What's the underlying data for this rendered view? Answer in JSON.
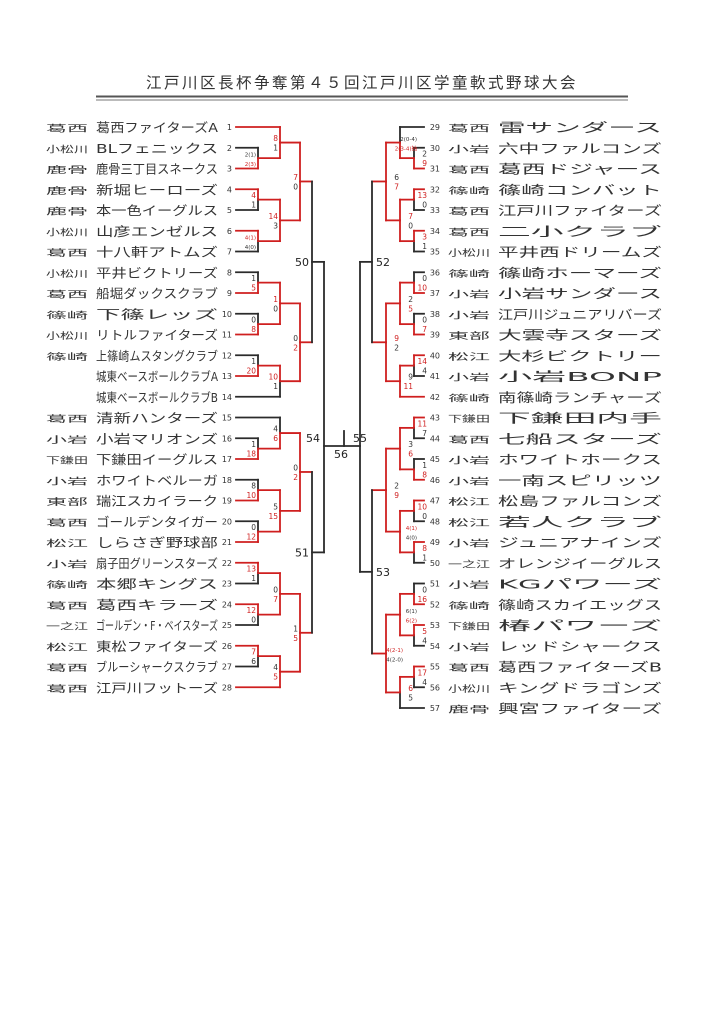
{
  "title": "江戸川区長杯争奪第４５回江戸川区学童軟式野球大会",
  "colors": {
    "win_path": "#cf1f1f",
    "line": "#2b2b2b",
    "score_win": "#cf1f1f",
    "score_lose": "#333333"
  },
  "bracket_labels": {
    "semi_left": "54",
    "semi_right": "55",
    "final": "56",
    "quarter_left_top": "50",
    "quarter_left_bottom": "51",
    "quarter_right_top": "52",
    "quarter_right_bottom": "53"
  },
  "teams": [
    {
      "n": 1,
      "region": "葛西",
      "name": "葛西ファイターズA"
    },
    {
      "n": 2,
      "region": "小松川",
      "name": "BLフェニックス"
    },
    {
      "n": 3,
      "region": "鹿骨",
      "name": "鹿骨三丁目スネークス"
    },
    {
      "n": 4,
      "region": "鹿骨",
      "name": "新堀ヒーローズ"
    },
    {
      "n": 5,
      "region": "鹿骨",
      "name": "本一色イーグルス"
    },
    {
      "n": 6,
      "region": "小松川",
      "name": "山彦エンゼルス"
    },
    {
      "n": 7,
      "region": "葛西",
      "name": "十八軒アトムズ"
    },
    {
      "n": 8,
      "region": "小松川",
      "name": "平井ビクトリーズ"
    },
    {
      "n": 9,
      "region": "葛西",
      "name": "船堀ダックスクラブ"
    },
    {
      "n": 10,
      "region": "篠崎",
      "name": "下篠レッズ"
    },
    {
      "n": 11,
      "region": "小松川",
      "name": "リトルファイターズ"
    },
    {
      "n": 12,
      "region": "篠崎",
      "name": "上篠崎ムスタングクラブ"
    },
    {
      "n": 13,
      "region": "",
      "name": "城東ベースボールクラブA"
    },
    {
      "n": 14,
      "region": "",
      "name": "城東ベースボールクラブB"
    },
    {
      "n": 15,
      "region": "葛西",
      "name": "清新ハンターズ"
    },
    {
      "n": 16,
      "region": "小岩",
      "name": "小岩マリオンズ"
    },
    {
      "n": 17,
      "region": "下鎌田",
      "name": "下鎌田イーグルス"
    },
    {
      "n": 18,
      "region": "小岩",
      "name": "ホワイトベルーガ"
    },
    {
      "n": 19,
      "region": "東部",
      "name": "瑞江スカイラーク"
    },
    {
      "n": 20,
      "region": "葛西",
      "name": "ゴールデンタイガー"
    },
    {
      "n": 21,
      "region": "松江",
      "name": "しらさぎ野球部"
    },
    {
      "n": 22,
      "region": "小岩",
      "name": "扇子田グリーンスターズ"
    },
    {
      "n": 23,
      "region": "篠崎",
      "name": "本郷キングス"
    },
    {
      "n": 24,
      "region": "葛西",
      "name": "葛西キラーズ"
    },
    {
      "n": 25,
      "region": "一之江",
      "name": "ゴールデン・F・ベイスターズ"
    },
    {
      "n": 26,
      "region": "松江",
      "name": "東松ファイターズ"
    },
    {
      "n": 27,
      "region": "葛西",
      "name": "ブルーシャークスクラブ"
    },
    {
      "n": 28,
      "region": "葛西",
      "name": "江戸川フットーズ"
    },
    {
      "n": 29,
      "region": "葛西",
      "name": "雷サンダース"
    },
    {
      "n": 30,
      "region": "小岩",
      "name": "六中ファルコンズ"
    },
    {
      "n": 31,
      "region": "葛西",
      "name": "葛西ドジャース"
    },
    {
      "n": 32,
      "region": "篠崎",
      "name": "篠崎コンバット"
    },
    {
      "n": 33,
      "region": "葛西",
      "name": "江戸川ファイターズ"
    },
    {
      "n": 34,
      "region": "葛西",
      "name": "二小クラブ"
    },
    {
      "n": 35,
      "region": "小松川",
      "name": "平井西ドリームズ"
    },
    {
      "n": 36,
      "region": "篠崎",
      "name": "篠崎ホーマーズ"
    },
    {
      "n": 37,
      "region": "小岩",
      "name": "小岩サンダース"
    },
    {
      "n": 38,
      "region": "小岩",
      "name": "江戸川ジュニアリバーズ"
    },
    {
      "n": 39,
      "region": "東部",
      "name": "大雲寺スターズ"
    },
    {
      "n": 40,
      "region": "松江",
      "name": "大杉ビクトリー"
    },
    {
      "n": 41,
      "region": "小岩",
      "name": "小岩BONP"
    },
    {
      "n": 42,
      "region": "篠崎",
      "name": "南篠崎ランチャーズ"
    },
    {
      "n": 43,
      "region": "下鎌田",
      "name": "下鎌田内手"
    },
    {
      "n": 44,
      "region": "葛西",
      "name": "七船スターズ"
    },
    {
      "n": 45,
      "region": "小岩",
      "name": "ホワイトホークス"
    },
    {
      "n": 46,
      "region": "小岩",
      "name": "一南スピリッツ"
    },
    {
      "n": 47,
      "region": "松江",
      "name": "松島ファルコンズ"
    },
    {
      "n": 48,
      "region": "松江",
      "name": "若人クラブ"
    },
    {
      "n": 49,
      "region": "小岩",
      "name": "ジュニアナインズ"
    },
    {
      "n": 50,
      "region": "一之江",
      "name": "オレンジイーグルス"
    },
    {
      "n": 51,
      "region": "小岩",
      "name": "KGパワーズ"
    },
    {
      "n": 52,
      "region": "篠崎",
      "name": "篠崎スカイエッグス"
    },
    {
      "n": 53,
      "region": "下鎌田",
      "name": "椿パワーズ"
    },
    {
      "n": 54,
      "region": "小岩",
      "name": "レッドシャークス"
    },
    {
      "n": 55,
      "region": "葛西",
      "name": "葛西ファイターズB"
    },
    {
      "n": 56,
      "region": "小松川",
      "name": "キングドラゴンズ"
    },
    {
      "n": 57,
      "region": "鹿骨",
      "name": "興宮ファイターズ"
    }
  ],
  "matches": [
    {
      "id": "m23",
      "side": "L",
      "lvl": 1,
      "top": "T2",
      "bot": "T3",
      "s": [
        "2(1)",
        "2(3)"
      ],
      "w": "b",
      "tiny": true
    },
    {
      "id": "m1",
      "side": "L",
      "lvl": 2,
      "top": "T1",
      "bot": "m23",
      "s": [
        "8",
        "1"
      ],
      "w": "t"
    },
    {
      "id": "m45",
      "side": "L",
      "lvl": 1,
      "top": "T4",
      "bot": "T5",
      "s": [
        "4",
        "1"
      ],
      "w": "t"
    },
    {
      "id": "m67",
      "side": "L",
      "lvl": 1,
      "top": "T6",
      "bot": "T7",
      "s": [
        "4(1)",
        "4(0)"
      ],
      "w": "t",
      "tiny": true
    },
    {
      "id": "mE",
      "side": "L",
      "lvl": 2,
      "top": "m45",
      "bot": "m67",
      "s": [
        "14",
        "3"
      ],
      "w": "t"
    },
    {
      "id": "mQFA",
      "side": "L",
      "lvl": 3,
      "top": "m1",
      "bot": "mE",
      "s": [
        "7",
        "0"
      ],
      "w": "t"
    },
    {
      "id": "m89",
      "side": "L",
      "lvl": 1,
      "top": "T8",
      "bot": "T9",
      "s": [
        "1",
        "5"
      ],
      "w": "b"
    },
    {
      "id": "m1011",
      "side": "L",
      "lvl": 1,
      "top": "T10",
      "bot": "T11",
      "s": [
        "0",
        "8"
      ],
      "w": "b"
    },
    {
      "id": "mI",
      "side": "L",
      "lvl": 2,
      "top": "m89",
      "bot": "m1011",
      "s": [
        "1",
        "0"
      ],
      "w": "t"
    },
    {
      "id": "m1213",
      "side": "L",
      "lvl": 1,
      "top": "T12",
      "bot": "T13",
      "s": [
        "1",
        "20"
      ],
      "w": "b"
    },
    {
      "id": "mK",
      "side": "L",
      "lvl": 2,
      "top": "m1213",
      "bot": "T14",
      "s": [
        "10",
        "1"
      ],
      "w": "t"
    },
    {
      "id": "mQFB",
      "side": "L",
      "lvl": 3,
      "top": "mI",
      "bot": "mK",
      "s": [
        "0",
        "2"
      ],
      "w": "b"
    },
    {
      "id": "m1617",
      "side": "L",
      "lvl": 1,
      "top": "T16",
      "bot": "T17",
      "s": [
        "1",
        "18"
      ],
      "w": "b"
    },
    {
      "id": "mN",
      "side": "L",
      "lvl": 2,
      "top": "T15",
      "bot": "m1617",
      "s": [
        "4",
        "6"
      ],
      "w": "b"
    },
    {
      "id": "m1819",
      "side": "L",
      "lvl": 1,
      "top": "T18",
      "bot": "T19",
      "s": [
        "8",
        "10"
      ],
      "w": "b"
    },
    {
      "id": "m2021",
      "side": "L",
      "lvl": 1,
      "top": "T20",
      "bot": "T21",
      "s": [
        "0",
        "12"
      ],
      "w": "b"
    },
    {
      "id": "mQ",
      "side": "L",
      "lvl": 2,
      "top": "m1819",
      "bot": "m2021",
      "s": [
        "5",
        "15"
      ],
      "w": "b"
    },
    {
      "id": "mQFC",
      "side": "L",
      "lvl": 3,
      "top": "mN",
      "bot": "mQ",
      "s": [
        "0",
        "2"
      ],
      "w": "b"
    },
    {
      "id": "m2223",
      "side": "L",
      "lvl": 1,
      "top": "T22",
      "bot": "T23",
      "s": [
        "13",
        "1"
      ],
      "w": "t"
    },
    {
      "id": "m2425",
      "side": "L",
      "lvl": 1,
      "top": "T24",
      "bot": "T25",
      "s": [
        "12",
        "0"
      ],
      "w": "t"
    },
    {
      "id": "mU",
      "side": "L",
      "lvl": 2,
      "top": "m2223",
      "bot": "m2425",
      "s": [
        "0",
        "7"
      ],
      "w": "b"
    },
    {
      "id": "m2627",
      "side": "L",
      "lvl": 1,
      "top": "T26",
      "bot": "T27",
      "s": [
        "7",
        "6"
      ],
      "w": "t"
    },
    {
      "id": "mW",
      "side": "L",
      "lvl": 2,
      "top": "m2627",
      "bot": "T28",
      "s": [
        "4",
        "5"
      ],
      "w": "b"
    },
    {
      "id": "mQFD",
      "side": "L",
      "lvl": 3,
      "top": "mU",
      "bot": "mW",
      "s": [
        "1",
        "5"
      ],
      "w": "b"
    },
    {
      "id": "m3031",
      "side": "R",
      "lvl": 1,
      "top": "T30",
      "bot": "T31",
      "s": [
        "2",
        "9"
      ],
      "w": "b"
    },
    {
      "id": "mB29",
      "side": "R",
      "lvl": 2,
      "top": "T29",
      "bot": "m3031",
      "s": [
        "2(0-4)",
        "2(3-4)抽"
      ],
      "w": "b",
      "tiny": true
    },
    {
      "id": "m3233",
      "side": "R",
      "lvl": 1,
      "top": "T32",
      "bot": "T33",
      "s": [
        "13",
        "0"
      ],
      "w": "t"
    },
    {
      "id": "m3435",
      "side": "R",
      "lvl": 1,
      "top": "T34",
      "bot": "T35",
      "s": [
        "3",
        "1"
      ],
      "w": "t"
    },
    {
      "id": "mE2",
      "side": "R",
      "lvl": 2,
      "top": "m3233",
      "bot": "m3435",
      "s": [
        "7",
        "0"
      ],
      "w": "t"
    },
    {
      "id": "mQF1",
      "side": "R",
      "lvl": 3,
      "top": "mB29",
      "bot": "mE2",
      "s": [
        "6",
        "7"
      ],
      "w": "b"
    },
    {
      "id": "m3637",
      "side": "R",
      "lvl": 1,
      "top": "T36",
      "bot": "T37",
      "s": [
        "0",
        "10"
      ],
      "w": "b"
    },
    {
      "id": "m3839",
      "side": "R",
      "lvl": 1,
      "top": "T38",
      "bot": "T39",
      "s": [
        "0",
        "7"
      ],
      "w": "b"
    },
    {
      "id": "mI2",
      "side": "R",
      "lvl": 2,
      "top": "m3637",
      "bot": "m3839",
      "s": [
        "2",
        "5"
      ],
      "w": "b"
    },
    {
      "id": "m4041",
      "side": "R",
      "lvl": 1,
      "top": "T40",
      "bot": "T41",
      "s": [
        "14",
        "4"
      ],
      "w": "t"
    },
    {
      "id": "mK2",
      "side": "R",
      "lvl": 2,
      "top": "m4041",
      "bot": "T42",
      "s": [
        "9",
        "11"
      ],
      "w": "b"
    },
    {
      "id": "mQF2",
      "side": "R",
      "lvl": 3,
      "top": "mI2",
      "bot": "mK2",
      "s": [
        "9",
        "2"
      ],
      "w": "t"
    },
    {
      "id": "m4344",
      "side": "R",
      "lvl": 1,
      "top": "T43",
      "bot": "T44",
      "s": [
        "11",
        "7"
      ],
      "w": "t"
    },
    {
      "id": "m4546",
      "side": "R",
      "lvl": 1,
      "top": "T45",
      "bot": "T46",
      "s": [
        "1",
        "8"
      ],
      "w": "b"
    },
    {
      "id": "mO2",
      "side": "R",
      "lvl": 2,
      "top": "m4344",
      "bot": "m4546",
      "s": [
        "3",
        "6"
      ],
      "w": "b"
    },
    {
      "id": "m4748",
      "side": "R",
      "lvl": 1,
      "top": "T47",
      "bot": "T48",
      "s": [
        "10",
        "0"
      ],
      "w": "t"
    },
    {
      "id": "m4950",
      "side": "R",
      "lvl": 1,
      "top": "T49",
      "bot": "T50",
      "s": [
        "8",
        "1"
      ],
      "w": "t"
    },
    {
      "id": "mR2",
      "side": "R",
      "lvl": 2,
      "top": "m4748",
      "bot": "m4950",
      "s": [
        "4(1)",
        "4(0)"
      ],
      "w": "t",
      "tiny": true
    },
    {
      "id": "mQF3",
      "side": "R",
      "lvl": 3,
      "top": "mO2",
      "bot": "mR2",
      "s": [
        "2",
        "9"
      ],
      "w": "b"
    },
    {
      "id": "m5152",
      "side": "R",
      "lvl": 1,
      "top": "T51",
      "bot": "T52",
      "s": [
        "0",
        "16"
      ],
      "w": "b"
    },
    {
      "id": "m5354",
      "side": "R",
      "lvl": 1,
      "top": "T53",
      "bot": "T54",
      "s": [
        "5",
        "4"
      ],
      "w": "t"
    },
    {
      "id": "mV2",
      "side": "R",
      "lvl": 2,
      "top": "m5152",
      "bot": "m5354",
      "s": [
        "6(1)",
        "6(2)"
      ],
      "w": "b",
      "tiny": true
    },
    {
      "id": "m5556",
      "side": "R",
      "lvl": 1,
      "top": "T55",
      "bot": "T56",
      "s": [
        "17",
        "4"
      ],
      "w": "t"
    },
    {
      "id": "mX2",
      "side": "R",
      "lvl": 2,
      "top": "m5556",
      "bot": "T57",
      "s": [
        "6",
        "5"
      ],
      "w": "t"
    },
    {
      "id": "mQF4",
      "side": "R",
      "lvl": 3,
      "top": "mV2",
      "bot": "mX2",
      "s": [
        "4(2-1)",
        "4(2-0)"
      ],
      "w": "t",
      "tiny": true
    }
  ],
  "connectors": [
    {
      "id": "c50",
      "side": "L",
      "top": "mQFA",
      "bot": "mQFB",
      "label": "50"
    },
    {
      "id": "c51",
      "side": "L",
      "top": "mQFC",
      "bot": "mQFD",
      "label": "51"
    },
    {
      "id": "c52",
      "side": "R",
      "top": "mQF1",
      "bot": "mQF2",
      "label": "52"
    },
    {
      "id": "c53",
      "side": "R",
      "top": "mQF3",
      "bot": "mQF4",
      "label": "53"
    }
  ]
}
